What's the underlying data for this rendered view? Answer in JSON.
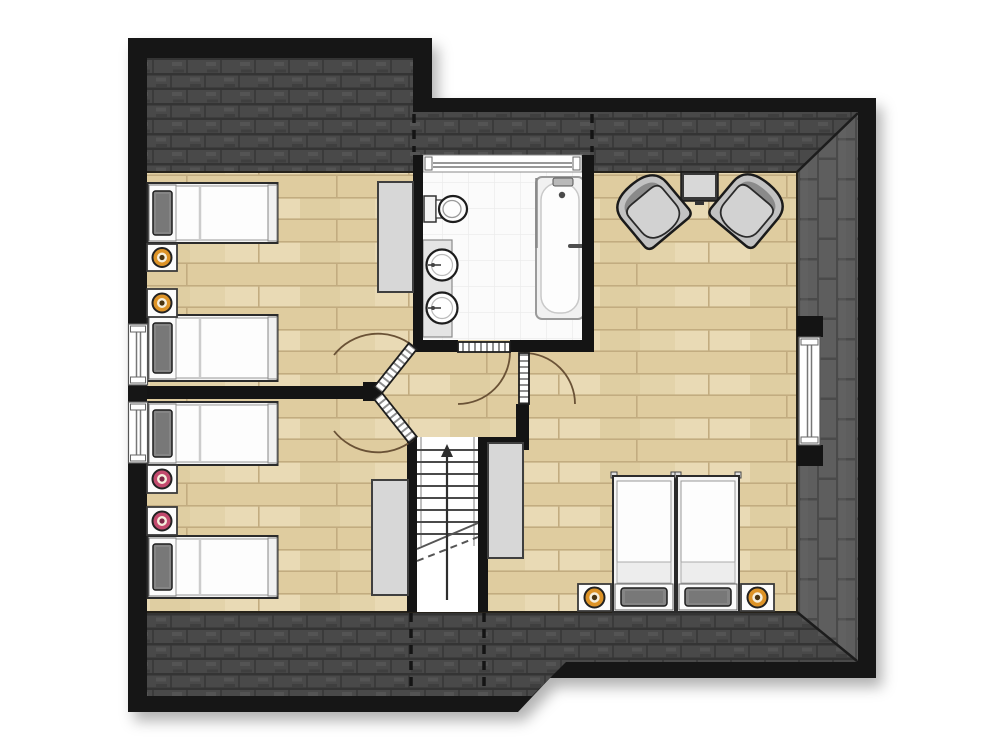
{
  "meta": {
    "kind": "architectural-floor-plan",
    "view": "top-down",
    "label": "Attic floor plan with roof, four-bed rooms, bathroom, landing with staircase and master bedroom",
    "visible_text": "none"
  },
  "colors": {
    "page_bg": "#ffffff",
    "wall": "#141414",
    "roof_dark": "#494949",
    "roof_dark_line": "#343434",
    "roof_dark_seam": "#3b3b3b",
    "roof_dark_hi": "#565656",
    "roof_light": "#5e5e5e",
    "roof_light_line": "#4a4a4a",
    "wood": "#e3d3aa",
    "wood_line": "#c2ac80",
    "bath_floor": "#fbfbfb",
    "bath_grid": "#ececec",
    "white_furn": "#f5f5f5",
    "gray_furn": "#d7d7d7",
    "pillow": "#858585",
    "door_arc": "#6a5236",
    "lamp_orange": "#dd9327",
    "lamp_pink": "#c34a6e"
  },
  "rooms": [
    {
      "id": "bedroom-upper-left",
      "label": "upper-left twin bedroom",
      "furniture": [
        "single-bed",
        "single-bed",
        "nightstand-with-orange-lamp",
        "nightstand-with-orange-lamp",
        "wardrobe"
      ]
    },
    {
      "id": "bedroom-lower-left",
      "label": "lower-left twin bedroom",
      "furniture": [
        "single-bed",
        "single-bed",
        "nightstand-with-pink-lamp",
        "nightstand-with-pink-lamp"
      ]
    },
    {
      "id": "bathroom",
      "label": "bathroom",
      "fixtures": [
        "toilet",
        "washbasin",
        "washbasin",
        "bathtub",
        "window"
      ]
    },
    {
      "id": "master-bedroom",
      "label": "master bedroom / sitting room",
      "furniture": [
        "armchair",
        "armchair",
        "tv-on-stand",
        "double-bed-two-singles",
        "nightstand-with-orange-lamp",
        "nightstand-with-orange-lamp",
        "wardrobe",
        "window"
      ]
    },
    {
      "id": "landing",
      "label": "landing with staircase",
      "features": [
        "staircase-up",
        "wardrobe",
        "wardrobe"
      ]
    }
  ],
  "stairs": {
    "direction": "up",
    "treads": 8
  },
  "counts": {
    "single_beds": 6,
    "nightstands": 6,
    "orange_lamps": 4,
    "pink_lamps": 2,
    "armchairs": 2,
    "wardrobes": 3,
    "interior_doors": 4,
    "windows": 4,
    "toilets": 1,
    "washbasins": 2,
    "bathtubs": 1
  }
}
